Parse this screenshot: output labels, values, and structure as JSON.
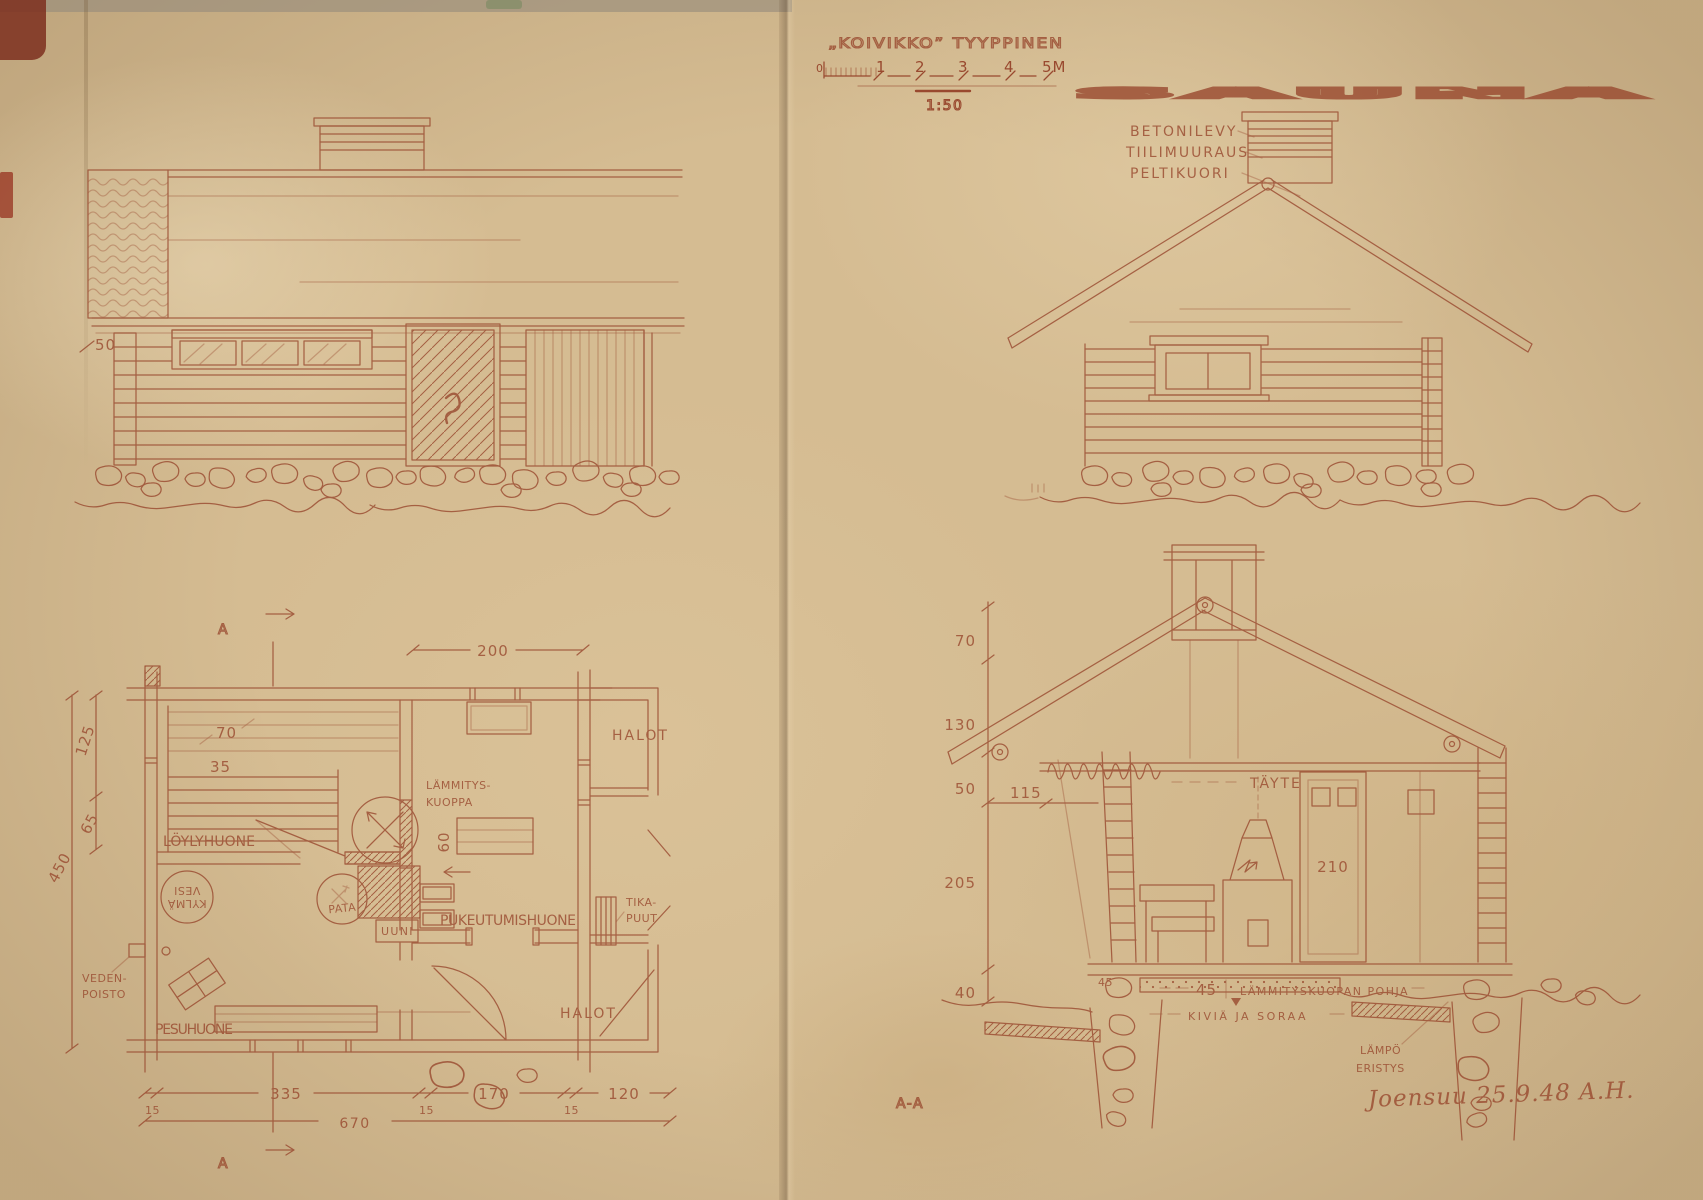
{
  "colors": {
    "ink": "#99492f",
    "paper": "#d5bc92"
  },
  "title": {
    "prefix": "„KOIVIKKO” TYYPPINEN",
    "main": "SAUNA",
    "ratio": "1:50",
    "scale_ticks": [
      "0",
      "1",
      "2",
      "3",
      "4",
      "5M"
    ]
  },
  "gable": {
    "labels": [
      "BETONILEVY",
      "TIILIMUURAUS",
      "PELTIKUORI"
    ]
  },
  "front": {
    "dim_50": "50"
  },
  "plan": {
    "marker": "A",
    "rooms": {
      "loyly": "LÖYLYHUONE",
      "pesu": "PESUHUONE",
      "puku": "PUKEUTUMISHUONE",
      "lammitys1": "LÄMMITYS-",
      "lammitys2": "KUOPPA",
      "halot_top": "HALOT",
      "halot_bottom": "HALOT",
      "tika1": "TIKA-",
      "tika2": "PUUT",
      "veden1": "VEDEN-",
      "veden2": "POISTO",
      "kylma1": "KYLMÄ",
      "kylma2": "VESI",
      "pata": "PATA",
      "uuni": "UUNI"
    },
    "dims": {
      "d200": "200",
      "d70": "70",
      "d35": "35",
      "d60": "60",
      "d125": "125",
      "d65": "65",
      "d450": "450",
      "d15": "15",
      "d335": "335",
      "d170": "170",
      "d120": "120",
      "d670": "670"
    }
  },
  "section": {
    "marker": "A-A",
    "labels": {
      "tayte": "TÄYTE",
      "pohja45": "45",
      "pohja": "LÄMMITYSKUOPAN POHJA",
      "kivia": "KIVIÄ JA SORAA",
      "lampo1": "LÄMPÖ",
      "lampo2": "ERISTYS"
    },
    "dims": {
      "d70": "70",
      "d130": "130",
      "d50": "50",
      "d205": "205",
      "d115": "115",
      "d40": "40",
      "d210": "210",
      "d45": "45"
    }
  },
  "signature": "Joensuu 25.9.48 A.H."
}
